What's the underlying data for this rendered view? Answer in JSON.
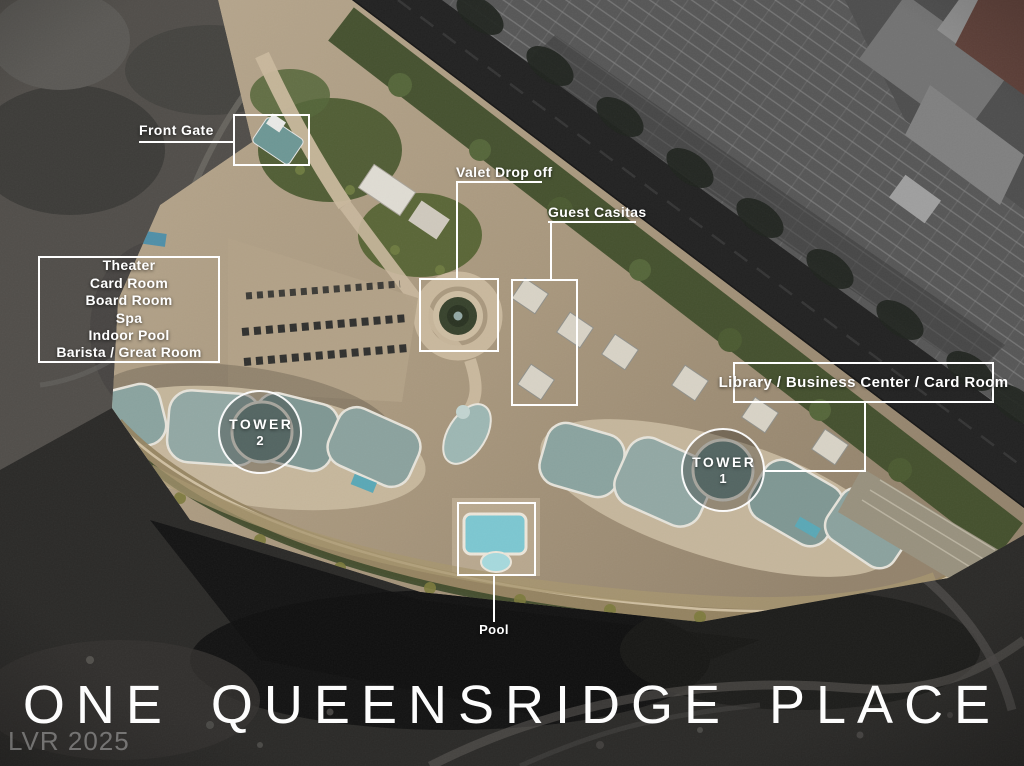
{
  "title": {
    "text": "ONE QUEENSRIDGE PLACE"
  },
  "watermark": {
    "text": "LVR 2025"
  },
  "labels": {
    "front_gate": "Front Gate",
    "valet": "Valet Drop off",
    "guest_casitas": "Guest Casitas",
    "library": "Library / Business Center / Card Room",
    "pool": "Pool"
  },
  "amenities": {
    "lines": [
      "Theater",
      "Card Room",
      "Board Room",
      "Spa",
      "Indoor Pool",
      "Barista / Great Room"
    ]
  },
  "towers": {
    "tower1": {
      "name": "TOWER",
      "number": "1"
    },
    "tower2": {
      "name": "TOWER",
      "number": "2"
    }
  },
  "colors": {
    "annotation_white": "#ffffff",
    "pool_water": "#7cc7d1",
    "roof_teal": "#7f9793",
    "grounds_beige": "#a8977d",
    "desert_dark": "#151514",
    "road_asphalt": "#222222"
  }
}
